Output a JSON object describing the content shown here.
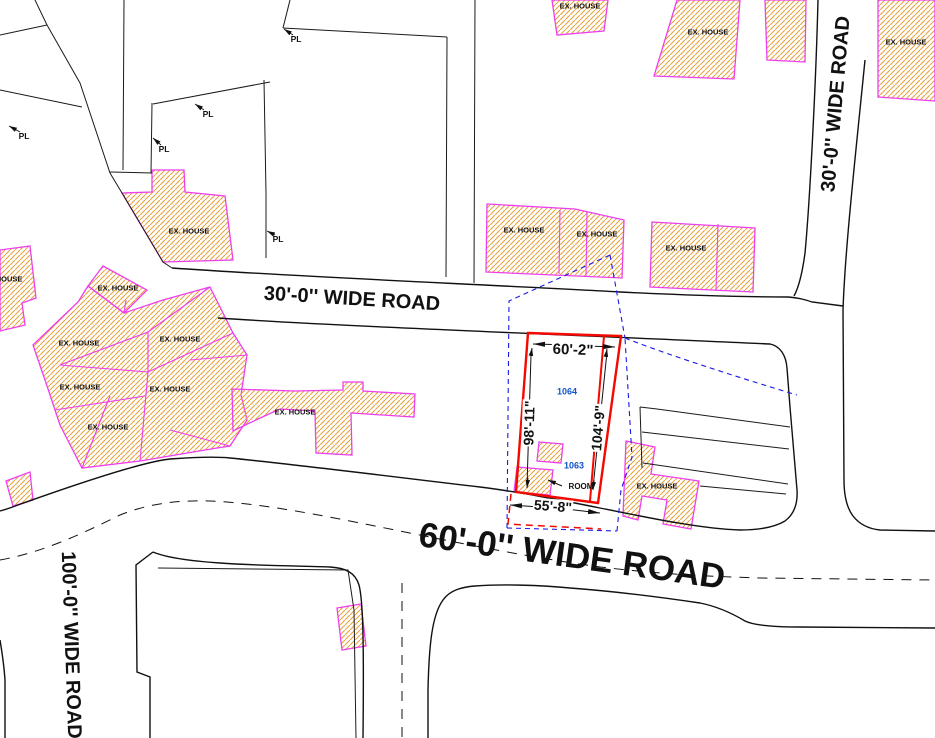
{
  "drawing": {
    "title": "site plan",
    "colors": {
      "hatch_fill": "#E8A33D",
      "house_outline": "#EE3FEE",
      "boundary_black": "#1B1B1B",
      "plot_red": "#F50800",
      "survey_blue": "#1A1AE6",
      "number_blue": "#1155CC"
    },
    "road_labels": [
      {
        "name": "road-label-30-horizontal",
        "text": "30'-0'' WIDE ROAD",
        "x": 352,
        "y": 299,
        "rot": 3.5,
        "size": 20,
        "weight": 600,
        "color": "#111111"
      },
      {
        "name": "road-label-60",
        "text": "60'-0'' WIDE ROAD",
        "x": 572,
        "y": 556,
        "rot": 8,
        "size": 35,
        "weight": 600,
        "color": "#111111"
      },
      {
        "name": "road-label-30-vertical",
        "text": "30'-0'' WIDE ROAD",
        "x": 836,
        "y": 104,
        "rot": -85,
        "size": 20,
        "weight": 600,
        "color": "#111111"
      },
      {
        "name": "road-label-100",
        "text": "100'-0'' WIDE ROAD",
        "x": 71,
        "y": 645,
        "rot": 88,
        "size": 20,
        "weight": 600,
        "color": "#111111"
      }
    ],
    "dimension_labels": [
      {
        "name": "dim-top",
        "text": "60'-2\"",
        "x": 573,
        "y": 350,
        "rot": 2,
        "size": 15,
        "weight": 600,
        "bg": true,
        "color": "#111111"
      },
      {
        "name": "dim-left",
        "text": "98'-11\"",
        "x": 529,
        "y": 423,
        "rot": -88,
        "size": 14,
        "weight": 600,
        "bg": true,
        "color": "#111111"
      },
      {
        "name": "dim-right",
        "text": "104'-9\"",
        "x": 598,
        "y": 428,
        "rot": -85,
        "size": 14,
        "weight": 600,
        "bg": true,
        "color": "#111111"
      },
      {
        "name": "dim-bottom",
        "text": "55'-8\"",
        "x": 553,
        "y": 506,
        "rot": 4.5,
        "size": 14,
        "weight": 600,
        "bg": true,
        "color": "#111111"
      }
    ],
    "plot_numbers": [
      {
        "name": "plot-number-1064",
        "text": "1064",
        "x": 567,
        "y": 392,
        "rot": 0,
        "size": 9,
        "weight": 700,
        "color": "#1155CC"
      },
      {
        "name": "plot-number-1063",
        "text": "1063",
        "x": 574,
        "y": 466,
        "rot": 0,
        "size": 9,
        "weight": 700,
        "color": "#1155CC"
      }
    ],
    "room_label": {
      "name": "room-label",
      "text": "ROOM",
      "x": 581,
      "y": 487,
      "rot": 0,
      "size": 8,
      "weight": 600,
      "color": "#111111"
    },
    "ex_house_labels": [
      {
        "name": "ex-house-label",
        "text": "EX. HOUSE",
        "x": 2,
        "y": 279
      },
      {
        "name": "ex-house-label",
        "text": "EX. HOUSE",
        "x": 118,
        "y": 288
      },
      {
        "name": "ex-house-label",
        "text": "EX. HOUSE",
        "x": 79,
        "y": 343
      },
      {
        "name": "ex-house-label",
        "text": "EX. HOUSE",
        "x": 180,
        "y": 339
      },
      {
        "name": "ex-house-label",
        "text": "EX. HOUSE",
        "x": 80,
        "y": 387
      },
      {
        "name": "ex-house-label",
        "text": "EX. HOUSE",
        "x": 170,
        "y": 389
      },
      {
        "name": "ex-house-label",
        "text": "EX. HOUSE",
        "x": 108,
        "y": 427
      },
      {
        "name": "ex-house-label",
        "text": "EX. HOUSE",
        "x": 295,
        "y": 412
      },
      {
        "name": "ex-house-label",
        "text": "EX. HOUSE",
        "x": 189,
        "y": 231
      },
      {
        "name": "ex-house-label",
        "text": "EX. HOUSE",
        "x": 580,
        "y": 6
      },
      {
        "name": "ex-house-label",
        "text": "EX. HOUSE",
        "x": 708,
        "y": 32
      },
      {
        "name": "ex-house-label",
        "text": "EX. HOUSE",
        "x": 906,
        "y": 42
      },
      {
        "name": "ex-house-label",
        "text": "EX. HOUSE",
        "x": 524,
        "y": 230
      },
      {
        "name": "ex-house-label",
        "text": "EX. HOUSE",
        "x": 597,
        "y": 234
      },
      {
        "name": "ex-house-label",
        "text": "EX. HOUSE",
        "x": 686,
        "y": 248
      },
      {
        "name": "ex-house-label",
        "text": "EX. HOUSE",
        "x": 657,
        "y": 486
      }
    ],
    "pl_labels": [
      {
        "name": "pl-label",
        "text": "PL",
        "x": 24,
        "y": 136
      },
      {
        "name": "pl-label",
        "text": "PL",
        "x": 164,
        "y": 149
      },
      {
        "name": "pl-label",
        "text": "PL",
        "x": 208,
        "y": 114
      },
      {
        "name": "pl-label",
        "text": "PL",
        "x": 296,
        "y": 39
      },
      {
        "name": "pl-label",
        "text": "PL",
        "x": 278,
        "y": 239
      }
    ]
  }
}
